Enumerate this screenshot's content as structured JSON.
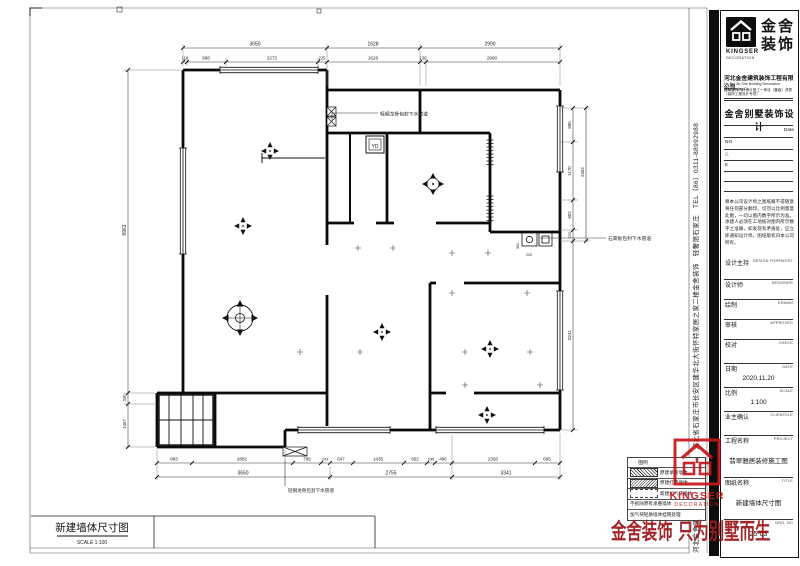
{
  "sheet": {
    "bottom_title": "新建墙体尺寸图",
    "bottom_scale": "SCALE 1:100"
  },
  "plan": {
    "notes": {
      "top_pipe": "轻钢龙骨包封下水管道",
      "right_pipe": "石膏板包封下水管道",
      "bottom_pipe": "轻钢龙骨包封下水管道",
      "flue_label": "YD"
    },
    "dims": {
      "top_row1": [
        "3650",
        "1628",
        "2990"
      ],
      "top_row2": [
        "110",
        "968",
        "2272",
        "225",
        "1628",
        "130",
        "2990"
      ],
      "left_col": [
        "9963",
        "330",
        "1467"
      ],
      "right_col1": [
        "680",
        "1170",
        "602",
        "220",
        "5241"
      ],
      "right_col2": [
        "2452"
      ],
      "bottom_row1": [
        "983",
        "2882",
        "795",
        "243",
        "647",
        "1435",
        "652",
        "235",
        "496",
        "2350",
        "695"
      ],
      "bottom_row2": [
        "3650",
        "2755",
        "3341"
      ],
      "interior": [
        "302",
        "220"
      ]
    }
  },
  "legend": {
    "header": "图例",
    "rows": [
      {
        "label": "原建承重墙体"
      },
      {
        "label": "原建红砖墙体"
      },
      {
        "label": "新建加气块墙体"
      },
      {
        "label": "不拆除原有承重墙体"
      },
      {
        "label": "加气块轻质墙体挂网处理"
      }
    ]
  },
  "titleblock": {
    "brand": {
      "name_line1": "金舍",
      "name_line2": "装饰",
      "logo_text": "KINGSER",
      "logo_sub": "DECORATION"
    },
    "company": "河北金舍建筑装饰工程有限公司",
    "company_en": "He Bei Jin She Building Decoration Engineering Co.",
    "qualification": "建筑装饰内外设计施工一体化（壹级）资质（装饰工程设计专项）",
    "product": "金舍别墅装饰设计",
    "date_label": "Date",
    "no_label": "NO.",
    "rev_mark": "△",
    "rev_e": "E",
    "disclaimer": "尊本公司设计师之图纸概不得随意将任何部分翻印。切勿以比例量度此图，一切以图内数字所示为准。承建人必须在工地核对图内所示数字之准确，如发现有矛盾处，应立即通知设计师。图纸版权归本公司所有。",
    "fields": [
      {
        "label": "设计主持",
        "en": "DESIGN FOREMOST",
        "value": ""
      },
      {
        "label": "设计师",
        "en": "DESIGNER",
        "value": ""
      },
      {
        "label": "绘制",
        "en": "DRAWN",
        "value": ""
      },
      {
        "label": "审核",
        "en": "APPROVED",
        "value": ""
      },
      {
        "label": "校对",
        "en": "CHECK",
        "value": ""
      },
      {
        "label": "日期",
        "en": "DATE",
        "value": "2020.11.20"
      },
      {
        "label": "比例",
        "en": "SCALE",
        "value": "1:100"
      },
      {
        "label": "业主确认",
        "en": "CLIENTELE",
        "value": ""
      },
      {
        "label": "工程名称",
        "en": "PROJECT",
        "value": "翡翠雅居装修施工图"
      },
      {
        "label": "图纸名称",
        "en": "TITLE",
        "value": "新建墙体尺寸图"
      },
      {
        "label": "",
        "en": "DRG. NO",
        "value": "25-03"
      }
    ]
  },
  "sidebar_strip": "河北金舍建筑装饰工程有限公司　河北省石家庄市长安区建华北大街怀特家居之家二楼金舍装饰　轻奢馆石家庄　TEL（86）0311-88992988",
  "watermark": {
    "logo_text": "KINGSER",
    "logo_sub": "DECORATION",
    "slogan": "金舍装饰 只为别墅而生"
  }
}
